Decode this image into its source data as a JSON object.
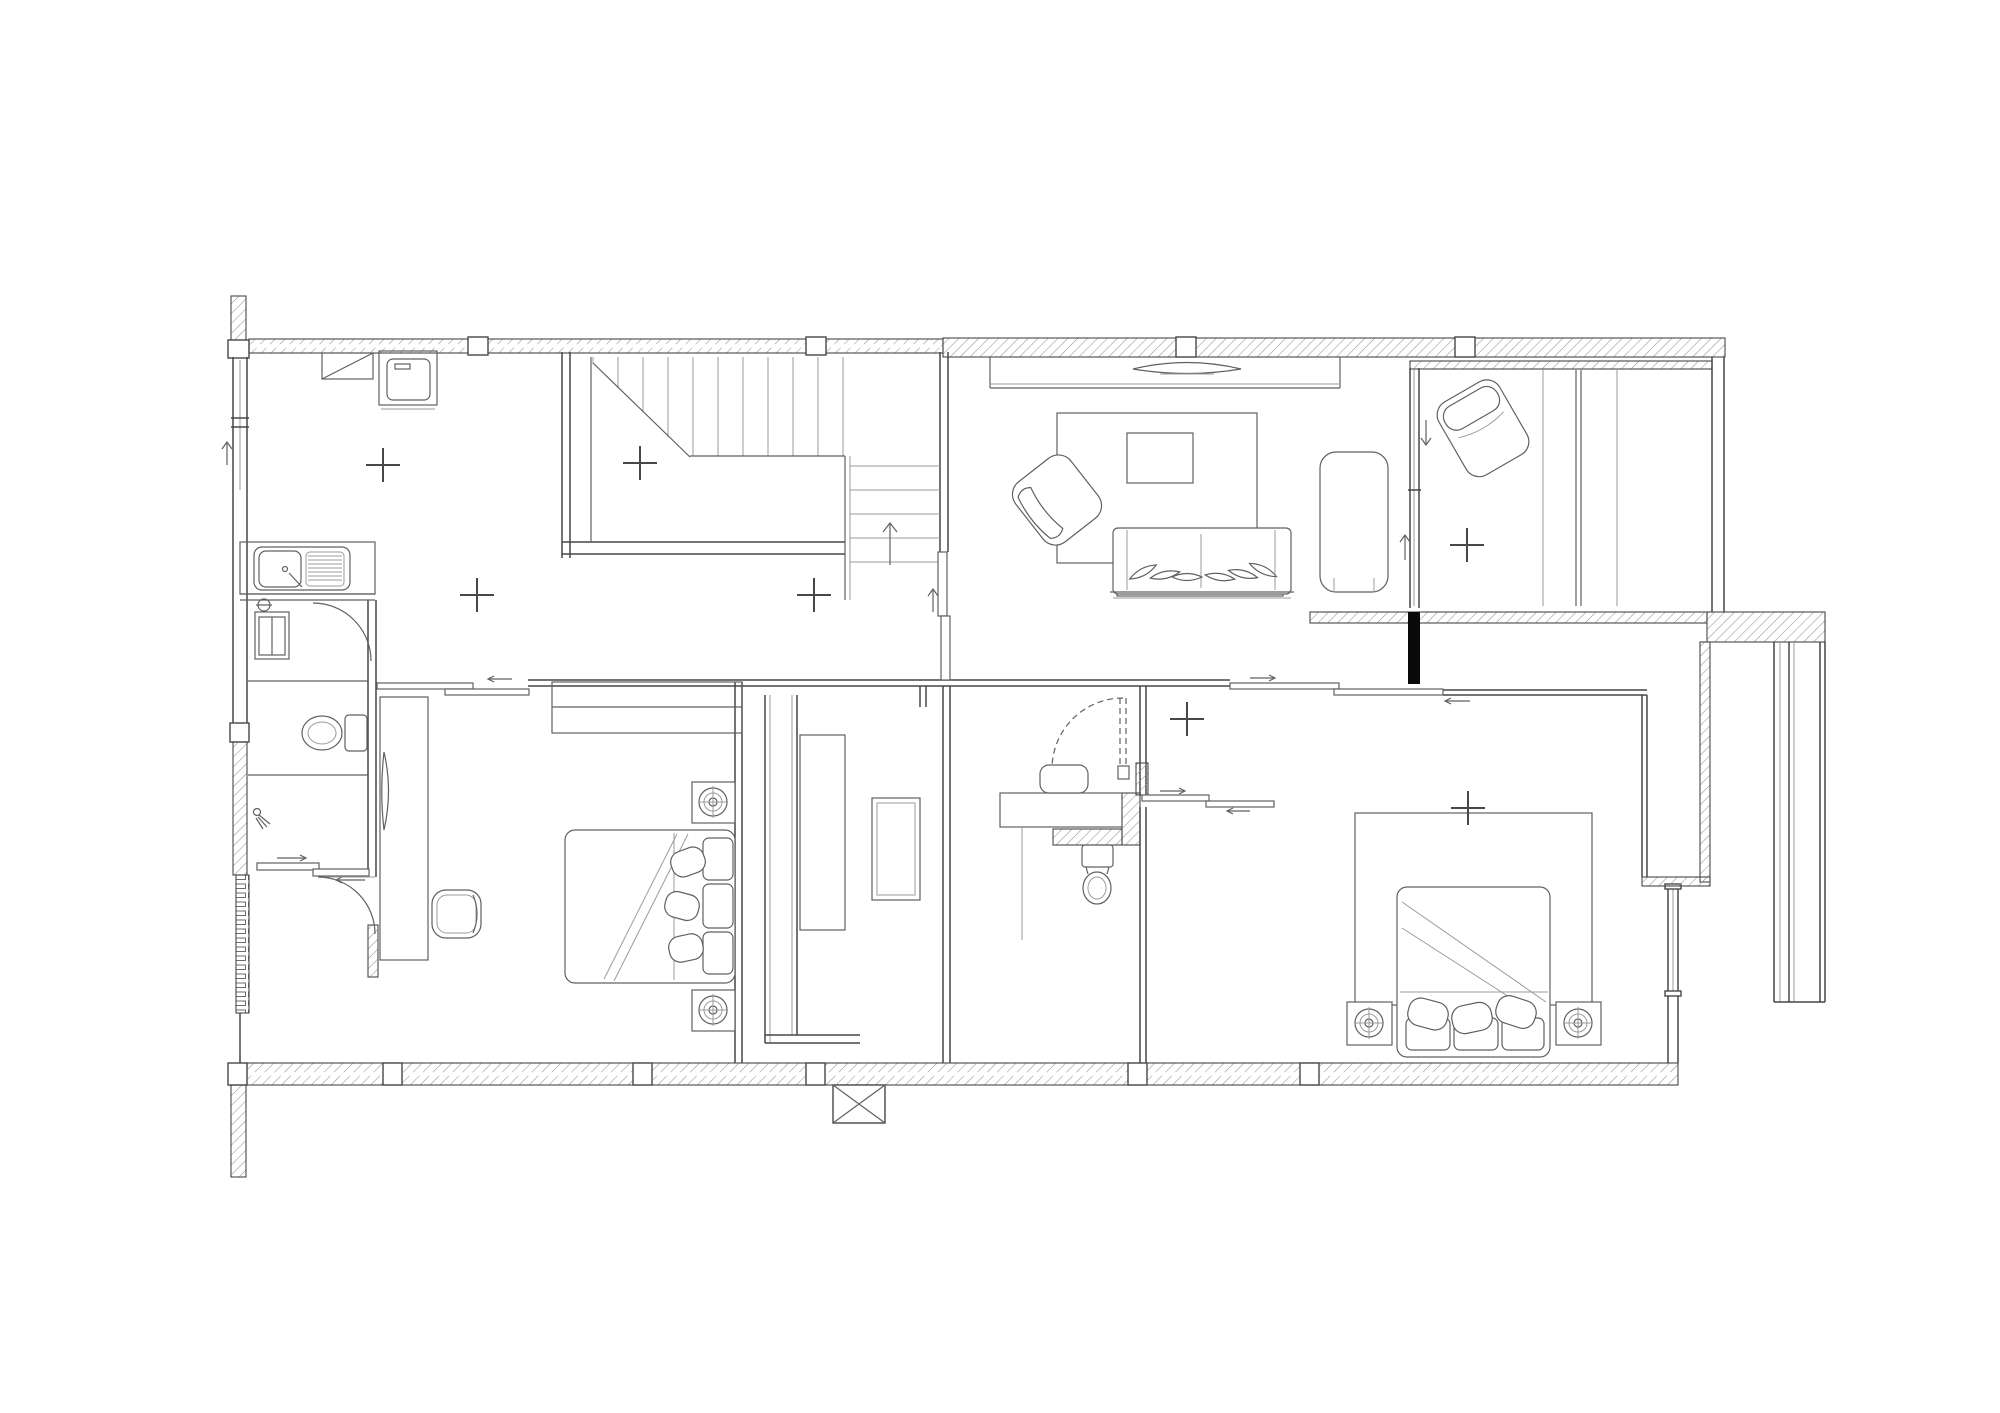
{
  "meta": {
    "drawing_type": "architectural-floor-plan",
    "visible_text": "none",
    "style": "black-and-white line drawing with hatched walls"
  },
  "colors": {
    "background": "#ffffff",
    "wall_line": "#474747",
    "furniture_line": "#606060",
    "light_line": "#9b9b9b",
    "hatch_line": "#949494",
    "solid_black": "#0a0a0a"
  },
  "legend": {
    "rooms": [
      "kitchen-laundry",
      "stairwell",
      "living-room",
      "balcony-lounge",
      "bathroom-left",
      "bedroom-left",
      "walk-in-closet",
      "bathroom-center",
      "bedroom-right"
    ],
    "fixtures": [
      "washing-machine",
      "dryer-appliance",
      "kitchen-sink-with-drainer",
      "tall-cabinet",
      "toilet",
      "shower-head",
      "vanity-basin",
      "staircase-with-up-arrow",
      "double-bed-with-pillows",
      "nightstand-downlight",
      "desk",
      "office-chair",
      "wall-mirror",
      "wardrobe",
      "closet-island",
      "sofa-with-cushions",
      "chaise-lounge",
      "coffee-table",
      "area-rug",
      "tv-on-console",
      "armchair",
      "lounge-chair",
      "console-table",
      "sliding-door",
      "swing-door",
      "window-glazing"
    ]
  },
  "counts": {
    "survey_cross_markers": 7,
    "beds": 2,
    "toilets": 2,
    "nightstand_downlights": 4,
    "sliding_doors": 6,
    "swing_doors": 4
  },
  "markers": {
    "stair_direction": "up",
    "cross_marker_symbol": "+"
  }
}
